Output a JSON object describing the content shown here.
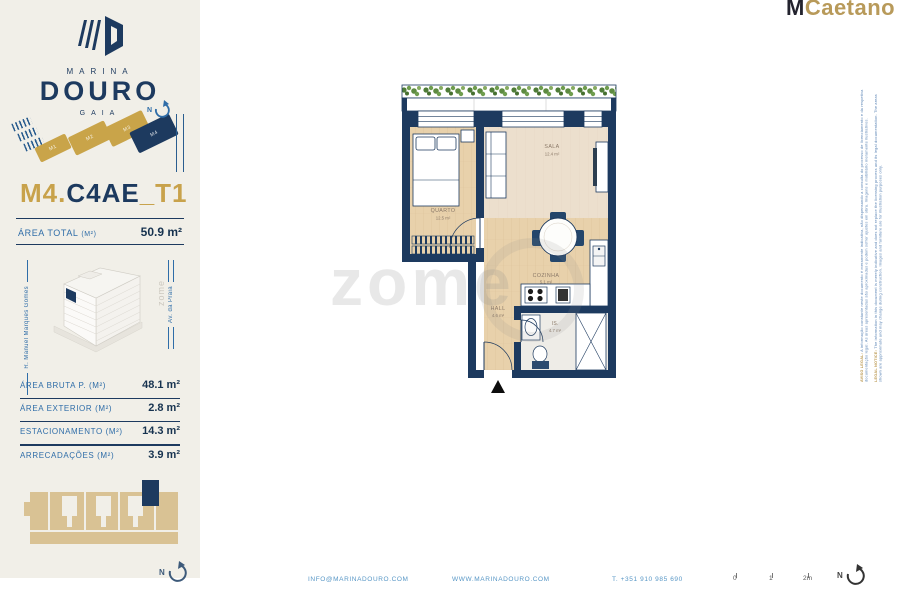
{
  "sidebar": {
    "logo": {
      "marina": "MARINA",
      "douro": "DOURO",
      "gaia": "GAIA"
    },
    "site_plan": {
      "buildings": [
        {
          "label": "M1"
        },
        {
          "label": "M2"
        },
        {
          "label": "M3"
        },
        {
          "label": "M4"
        }
      ],
      "highlighted": "M4",
      "compass": "N"
    },
    "unit_title": {
      "prefix": "M4.",
      "code": "C4AE",
      "suffix": "_T1"
    },
    "area_total": {
      "label": "ÁREA TOTAL",
      "unit_note": "(M²)",
      "value": "50.9 m²"
    },
    "streets": {
      "left": "R. Manuel Marques Gomes",
      "right": "Av. da Praia"
    },
    "areas_table": {
      "rows": [
        {
          "label": "ÁREA BRUTA P. (M²)",
          "value": "48.1 m²"
        },
        {
          "label": "ÁREA EXTERIOR (M²)",
          "value": "2.8 m²"
        },
        {
          "label": "ESTACIONAMENTO (M²)",
          "value": "14.3 m²"
        },
        {
          "label": "ARRECADAÇÕES (M²)",
          "value": "3.9 m²"
        }
      ]
    },
    "keyplan_compass": "N"
  },
  "header": {
    "agency_prefix": "M",
    "agency_name": "Caetano"
  },
  "floor_plan": {
    "rooms": [
      {
        "name": "QUARTO",
        "area": "12.5 m²"
      },
      {
        "name": "SALA",
        "area": "12.4 m²"
      },
      {
        "name": "COZINHA",
        "area": "5.1 m²"
      },
      {
        "name": "HALL",
        "area": "4.6 m²"
      },
      {
        "name": "IS.",
        "area": "4.7 m²"
      }
    ]
  },
  "watermark": {
    "text": "zome"
  },
  "disclaimer": {
    "pt_lead": "AVISO LEGAL:",
    "pt_text": " A informação constante neste documento é meramente indicativa, não dispensando a consulta do processo de licenciamento e da respetiva documentação legal. As áreas apresentadas são aproximadas e podem sofrer ajustes em obra. Imagens e mobiliário meramente ilustrativos.",
    "en_lead": "LEGAL NOTICE:",
    "en_text": " The information in this document is merely indicative and does not replace the licensing process and its legal documentation. The areas shown are approximate and may change during construction. Images and furniture are for illustration purposes only."
  },
  "footer": {
    "email": "INFO@MARINADOURO.COM",
    "website": "WWW.MARINADOURO.COM",
    "phone": "T. +351 910 985 690",
    "scale_labels": [
      "0",
      "1",
      "2m"
    ],
    "compass": "N"
  },
  "colors": {
    "navy": "#1d3a5f",
    "gold": "#c9a449",
    "cream": "#f1efe8",
    "blue_label": "#2f6da8",
    "wood": "#e8d1ab",
    "sala_floor": "#ecdfcd",
    "plant_green": "#5d8a41",
    "tan_keyplan": "#d9c294"
  }
}
